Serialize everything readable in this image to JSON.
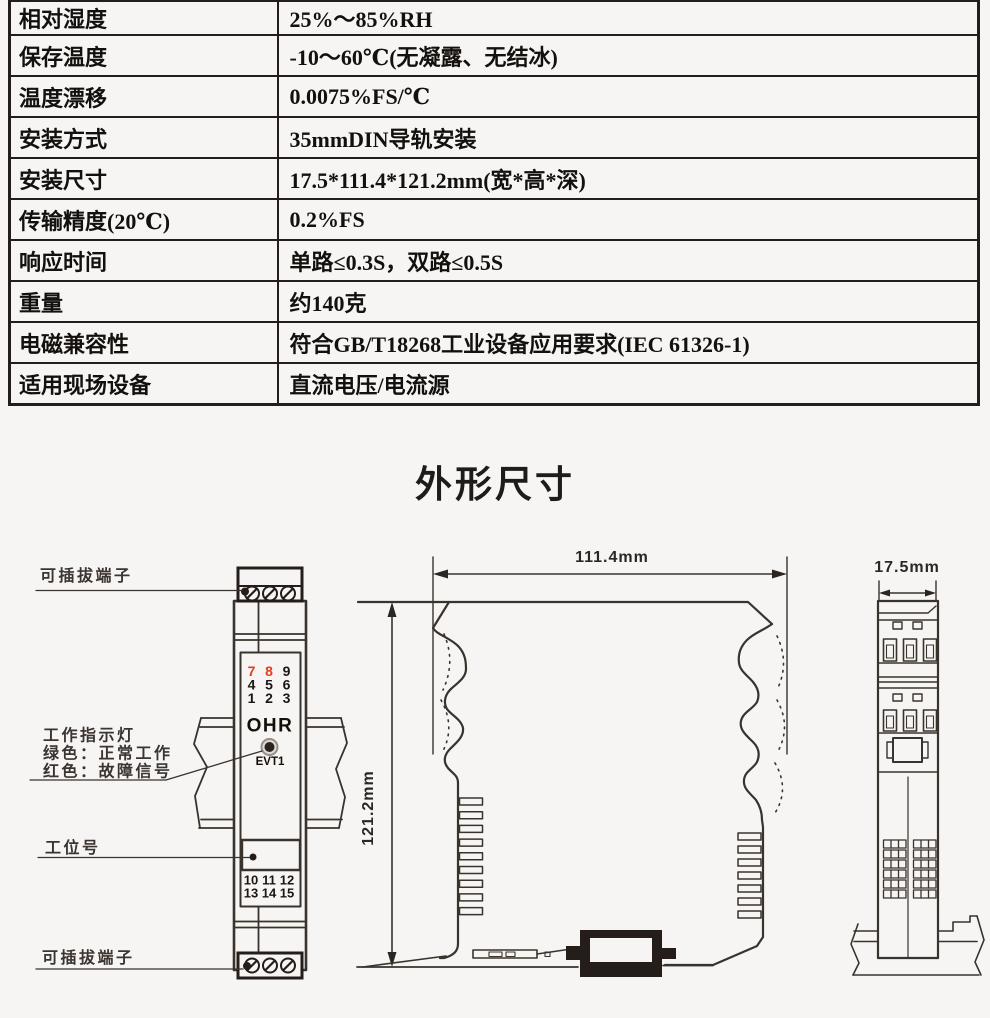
{
  "page": {
    "background": "#f6f5f3"
  },
  "spec_table": {
    "rows": [
      {
        "label": "相对湿度",
        "value": "25%～85%RH"
      },
      {
        "label": "保存温度",
        "value": "-10～60℃(无凝露、无结冰)"
      },
      {
        "label": "温度漂移",
        "value": "0.0075%FS/℃"
      },
      {
        "label": "安装方式",
        "value": "35mmDIN导轨安装"
      },
      {
        "label": "安装尺寸",
        "value": "17.5*111.4*121.2mm(宽*高*深)"
      },
      {
        "label": "传输精度(20℃)",
        "value": "0.2%FS"
      },
      {
        "label": "响应时间",
        "value": "单路≤0.3S，双路≤0.5S"
      },
      {
        "label": "重量",
        "value": "约140克"
      },
      {
        "label": "电磁兼容性",
        "value": "符合GB/T18268工业设备应用要求(IEC 61326-1)"
      },
      {
        "label": "适用现场设备",
        "value": "直流电压/电流源"
      }
    ]
  },
  "section_title": "外形尺寸",
  "diagram": {
    "callouts": {
      "terminal_top": "可插拔端子",
      "indicator_line1": "工作指示灯",
      "indicator_line2": "绿色：正常工作",
      "indicator_line3": "红色：故障信号",
      "station": "工位号",
      "terminal_bottom": "可插拔端子"
    },
    "front_view": {
      "brand": "OHR",
      "led_label": "EVT1",
      "top_terminal_numbers": [
        "7",
        "8",
        "9",
        "4",
        "5",
        "6",
        "1",
        "2",
        "3"
      ],
      "bottom_terminal_numbers": [
        "10",
        "11",
        "12",
        "13",
        "14",
        "15"
      ]
    },
    "dimensions": {
      "width": "111.4mm",
      "height": "121.2mm",
      "depth": "17.5mm"
    },
    "colors": {
      "highlight_red": "#e8391c",
      "line": "#3a332d"
    }
  }
}
